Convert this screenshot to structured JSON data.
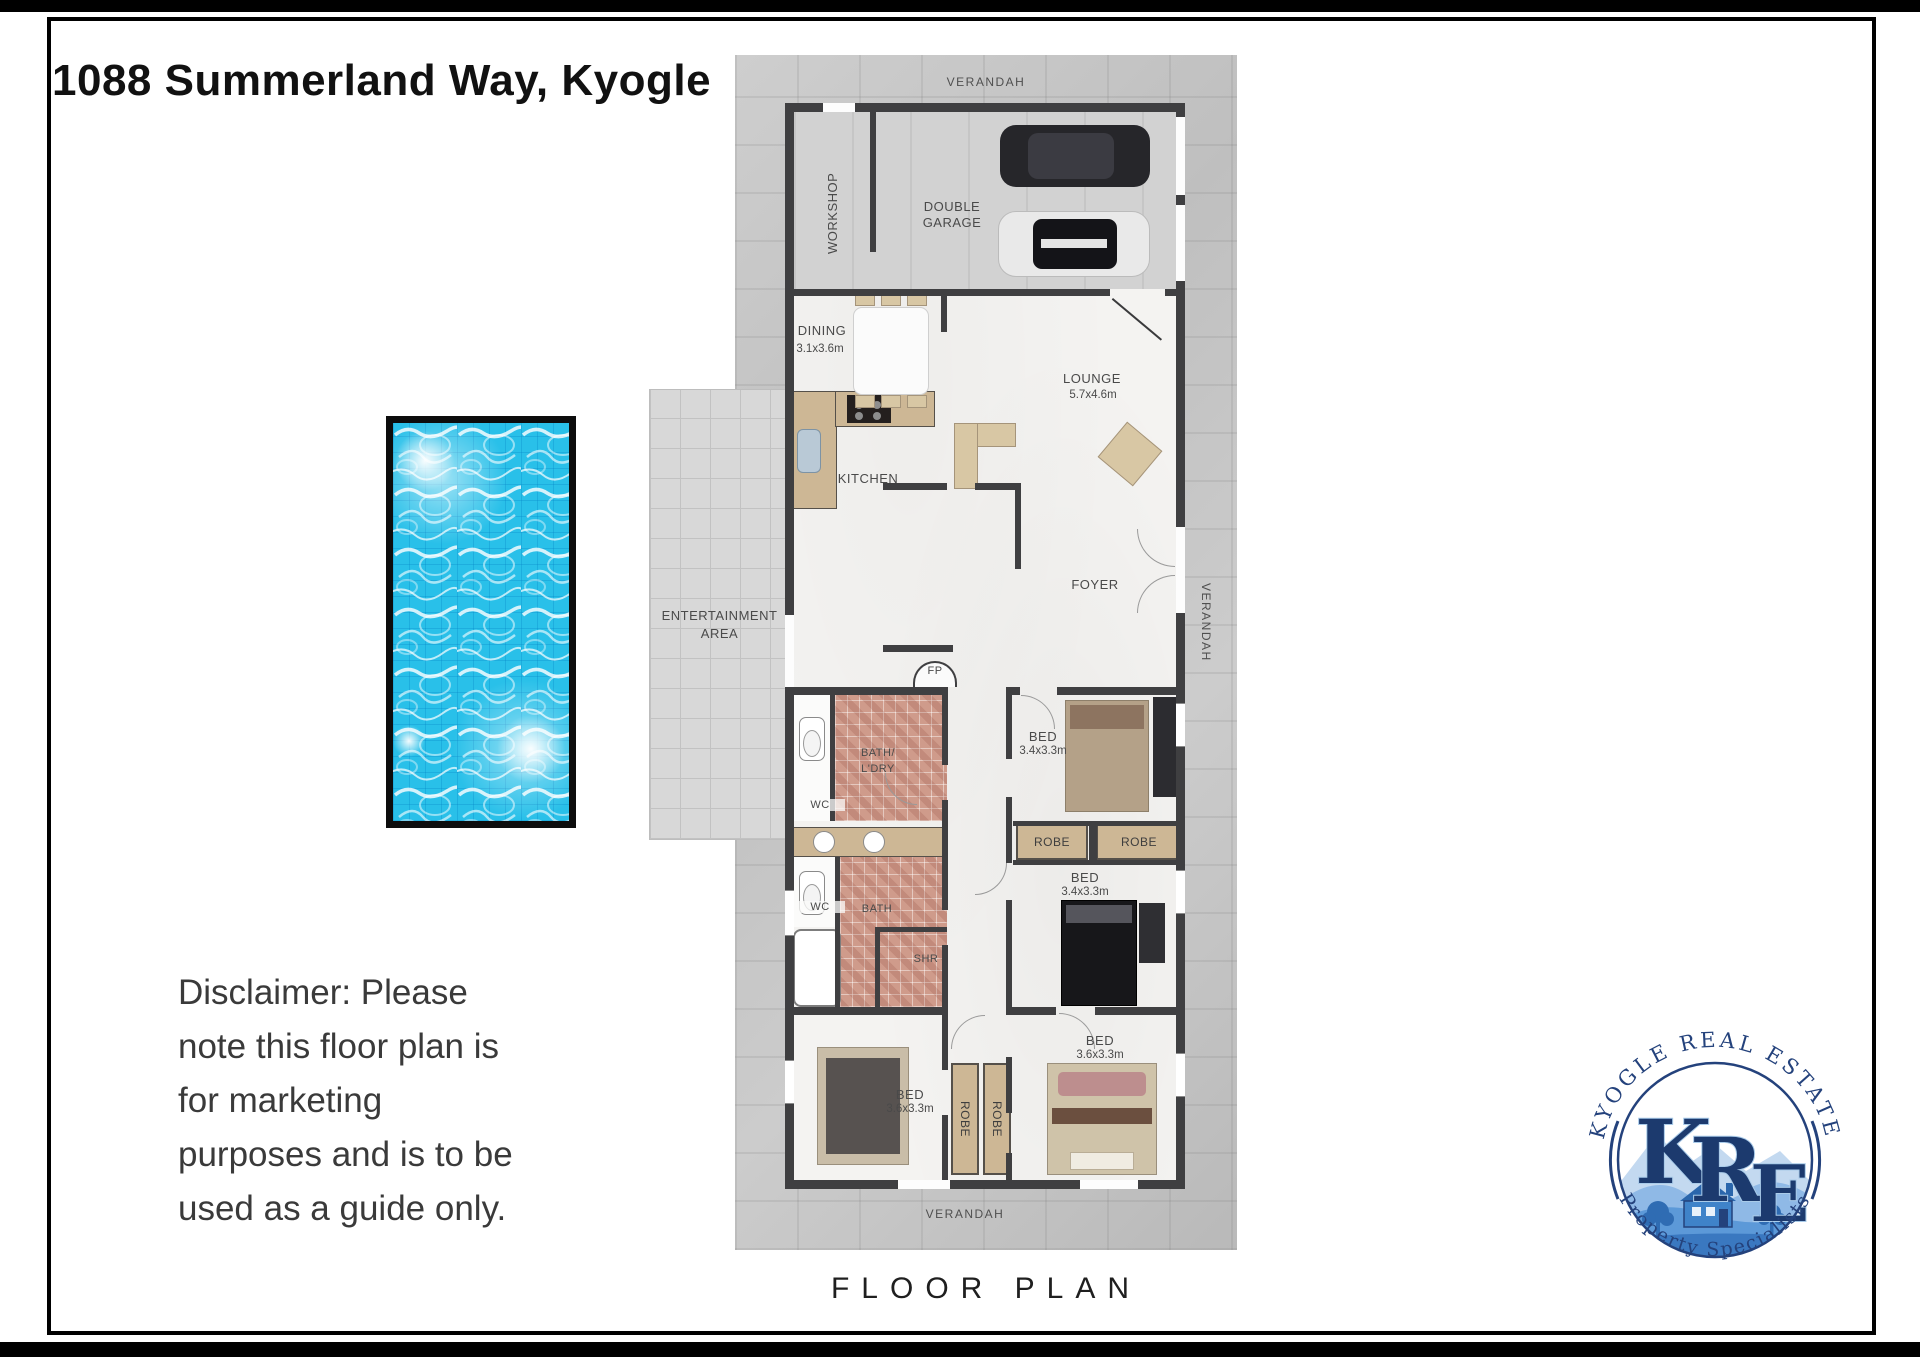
{
  "header": {
    "title": "1088 Summerland Way, Kyogle"
  },
  "plan": {
    "caption": "FLOOR PLAN",
    "verandah": "VERANDAH",
    "workshop": "WORKSHOP",
    "garage_l1": "DOUBLE",
    "garage_l2": "GARAGE",
    "dining": "DINING",
    "dining_dims": "3.1x3.6m",
    "lounge": "LOUNGE",
    "lounge_dims": "5.7x4.6m",
    "kitchen": "KITCHEN",
    "foyer": "FOYER",
    "entertainment_l1": "ENTERTAINMENT",
    "entertainment_l2": "AREA",
    "fireplace": "FP",
    "bath_ldry_l1": "BATH/",
    "bath_ldry_l2": "L'DRY",
    "wc": "WC",
    "bath": "BATH",
    "shower": "SHR",
    "robe": "ROBE",
    "bed": "BED",
    "bed_dims_a": "3.4x3.3m",
    "bed_dims_b": "3.6x3.3m"
  },
  "disclaimer": {
    "l1": "Disclaimer: Please",
    "l2": "note this floor plan is",
    "l3": "for marketing",
    "l4": "purposes and is to be",
    "l5": "used as a guide only."
  },
  "logo": {
    "arc_top": "KYOGLE REAL ESTATE",
    "arc_bottom": "Property Specialists",
    "k": "K",
    "r": "R",
    "e": "E"
  },
  "colors": {
    "wall": "#3f3f41",
    "tile": "#cf9b8b",
    "pool_water": "#29c0e9",
    "logo_navy": "#24427c",
    "furniture_tan": "#cdb795"
  }
}
